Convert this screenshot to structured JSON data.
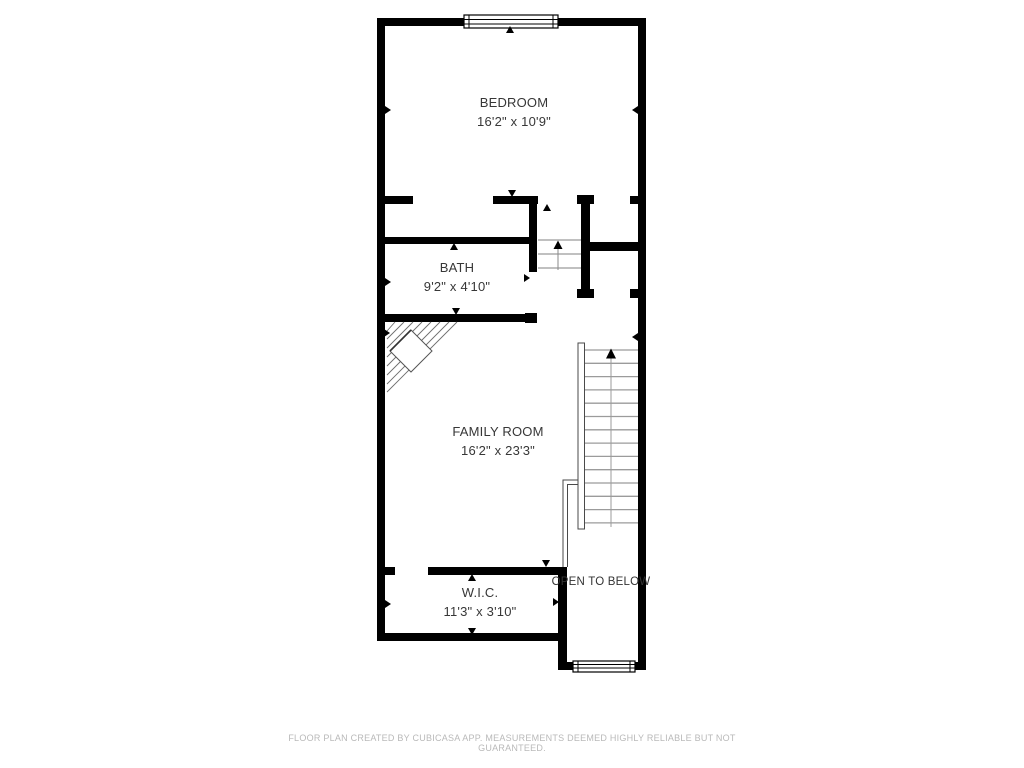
{
  "page": {
    "background": "#ffffff",
    "footer_disclaimer": "FLOOR PLAN CREATED BY CUBICASA APP. MEASUREMENTS DEEMED HIGHLY RELIABLE BUT NOT GUARANTEED."
  },
  "floor_plan": {
    "rooms": [
      {
        "id": "bedroom",
        "name": "BEDROOM",
        "dims": "16'2\" x 10'9\""
      },
      {
        "id": "bath",
        "name": "BATH",
        "dims": "9'2\" x 4'10\""
      },
      {
        "id": "family-room",
        "name": "FAMILY ROOM",
        "dims": "16'2\" x 23'3\""
      },
      {
        "id": "wic",
        "name": "W.I.C.",
        "dims": "11'3\" x 3'10\""
      }
    ],
    "annotations": [
      {
        "id": "open-below",
        "label": "OPEN TO BELOW"
      }
    ],
    "features": {
      "windows": [
        "top-wall-window",
        "bottom-wall-window"
      ],
      "stairs": [
        "main-staircase-up",
        "upper-run-staircase-up",
        "winder-staircase"
      ]
    },
    "colors": {
      "wall": "#000000",
      "stair_tread": "#9b9b9b",
      "stair_rail": "#4a4a4a",
      "hatch": "#6e6e6e",
      "label_text": "#373737",
      "footer_text": "#b9b9b9"
    }
  }
}
